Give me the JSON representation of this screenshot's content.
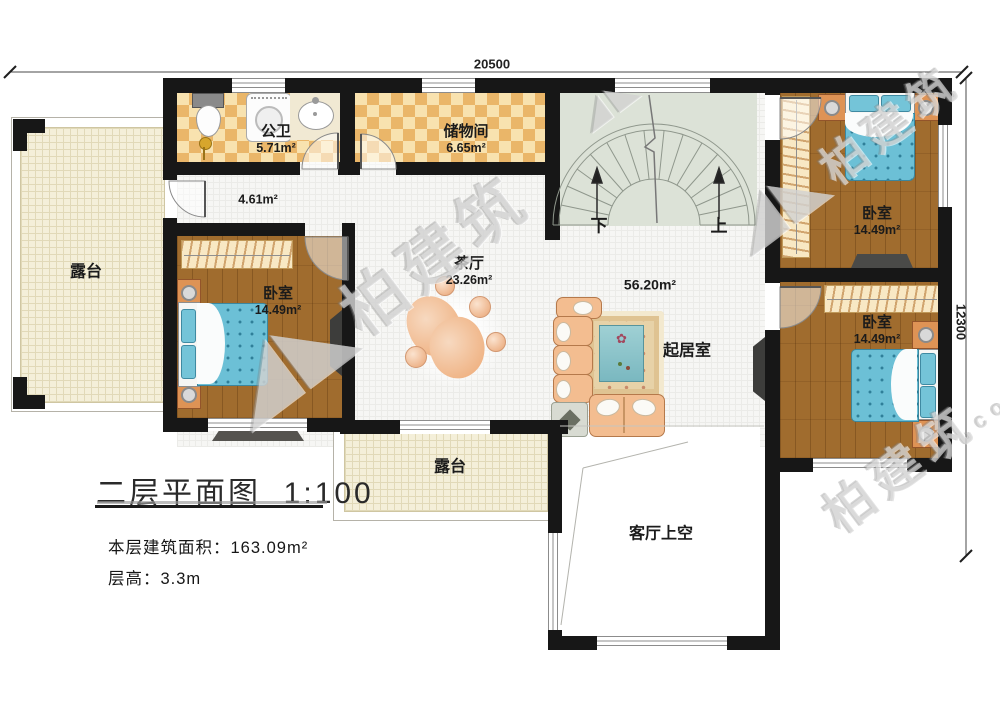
{
  "dimensions": {
    "width_mm": "20500",
    "height_mm": "12300"
  },
  "rooms": {
    "terrace_left": {
      "name": "露台"
    },
    "terrace_bottom": {
      "name": "露台"
    },
    "bathroom": {
      "name": "公卫",
      "area": "5.71m²"
    },
    "storage": {
      "name": "储物间",
      "area": "6.65m²"
    },
    "hallway": {
      "area": "4.61m²"
    },
    "tea_hall": {
      "name": "茶厅",
      "area": "23.26m²"
    },
    "living_zone": {
      "name": "起居室",
      "area": "56.20m²"
    },
    "bedroom_left": {
      "name": "卧室",
      "area": "14.49m²"
    },
    "bedroom_top_right": {
      "name": "卧室",
      "area": "14.49m²"
    },
    "bedroom_mid_right": {
      "name": "卧室",
      "area": "14.49m²"
    },
    "living_void": {
      "name": "客厅上空"
    }
  },
  "stairs": {
    "down_label": "下",
    "up_label": "上"
  },
  "title_block": {
    "title": "二层平面图",
    "scale": "1:100",
    "floor_area_label": "本层建筑面积：163.09m²",
    "floor_height_label": "层高：3.3m"
  },
  "watermark": {
    "logo": "◢◣",
    "brand": "柏建筑",
    "domain": "com"
  },
  "colors": {
    "wall": "#171717",
    "wood_floor": "#a06c2e",
    "tile_warm_dark": "#eab669",
    "tile_warm_light": "#f8e2af",
    "terrace_tile": "#f4efd9",
    "stair_floor": "#dce2d7",
    "bed_blue": "#6cc0d6",
    "sofa_tan": "#f3bd90"
  }
}
